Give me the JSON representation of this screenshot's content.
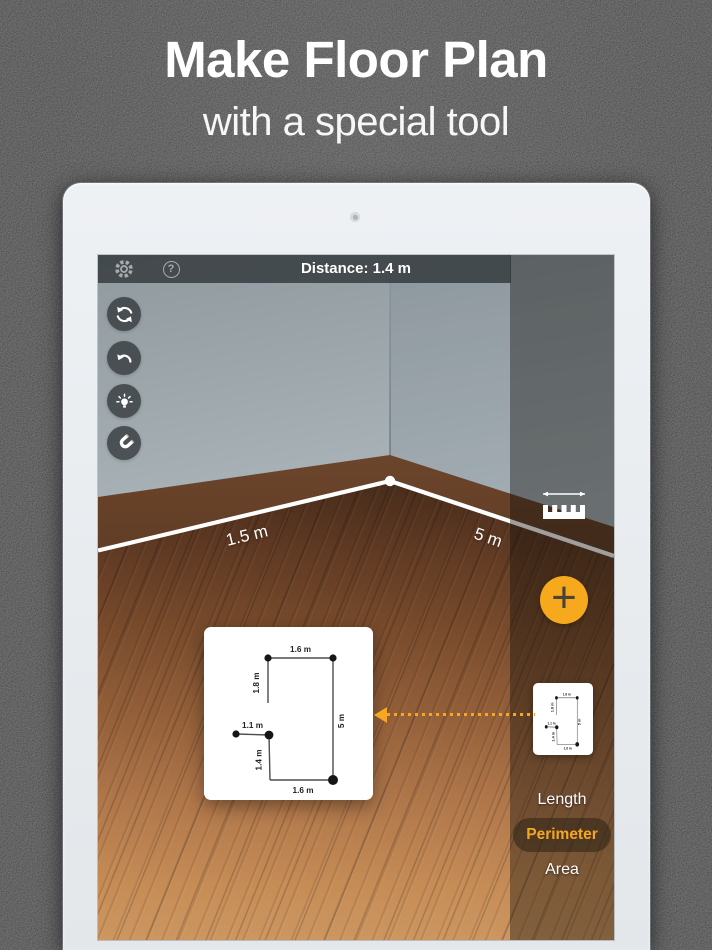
{
  "hero": {
    "title": "Make Floor Plan",
    "subtitle": "with a special tool"
  },
  "app": {
    "top_bar": {
      "distance": "Distance: 1.4 m",
      "help_glyph": "?"
    },
    "ar_measurements": {
      "left_wall": "1.5 m",
      "right_wall": "5 m"
    },
    "floor_plan": {
      "top": "1.6 m",
      "left_upper": "1.8 m",
      "left_mid": "1.1 m",
      "left_lower": "1.4 m",
      "right": "5 m",
      "bottom": "1.6 m"
    },
    "modes": {
      "length": "Length",
      "perimeter": "Perimeter",
      "area": "Area"
    },
    "add_glyph": "+"
  },
  "colors": {
    "accent_orange": "#F7A91D",
    "active_mode_text": "#F5A623",
    "measure_line": "#FFFFFF"
  }
}
